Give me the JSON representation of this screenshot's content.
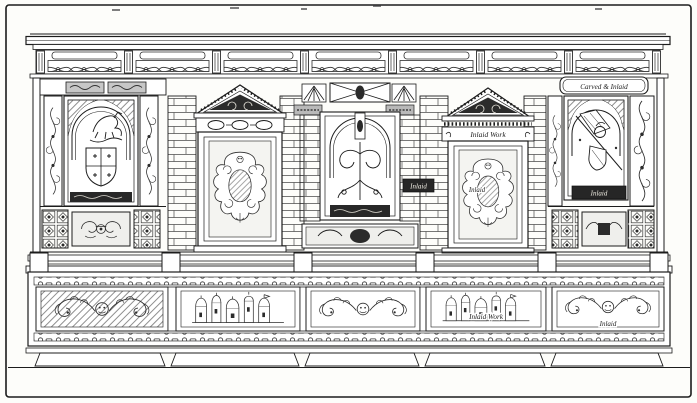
{
  "palette": {
    "paper": "#fdfdfa",
    "ink": "#1c1c1c",
    "panel_dark": "#262626",
    "label_light": "#f1eee4"
  },
  "engraving": {
    "annotations": {
      "right_bay_cartouche": "Carved & Inlaid",
      "right_door_frieze": "Inlaid Work",
      "right_door_jamb_block": "Inlaid",
      "right_door_cartouche": "Inlaid",
      "right_niche_plinth": "Inlaid",
      "drawer_townscape_label": "Inlaid Work",
      "drawer_scroll_label": "Inlaid"
    }
  }
}
